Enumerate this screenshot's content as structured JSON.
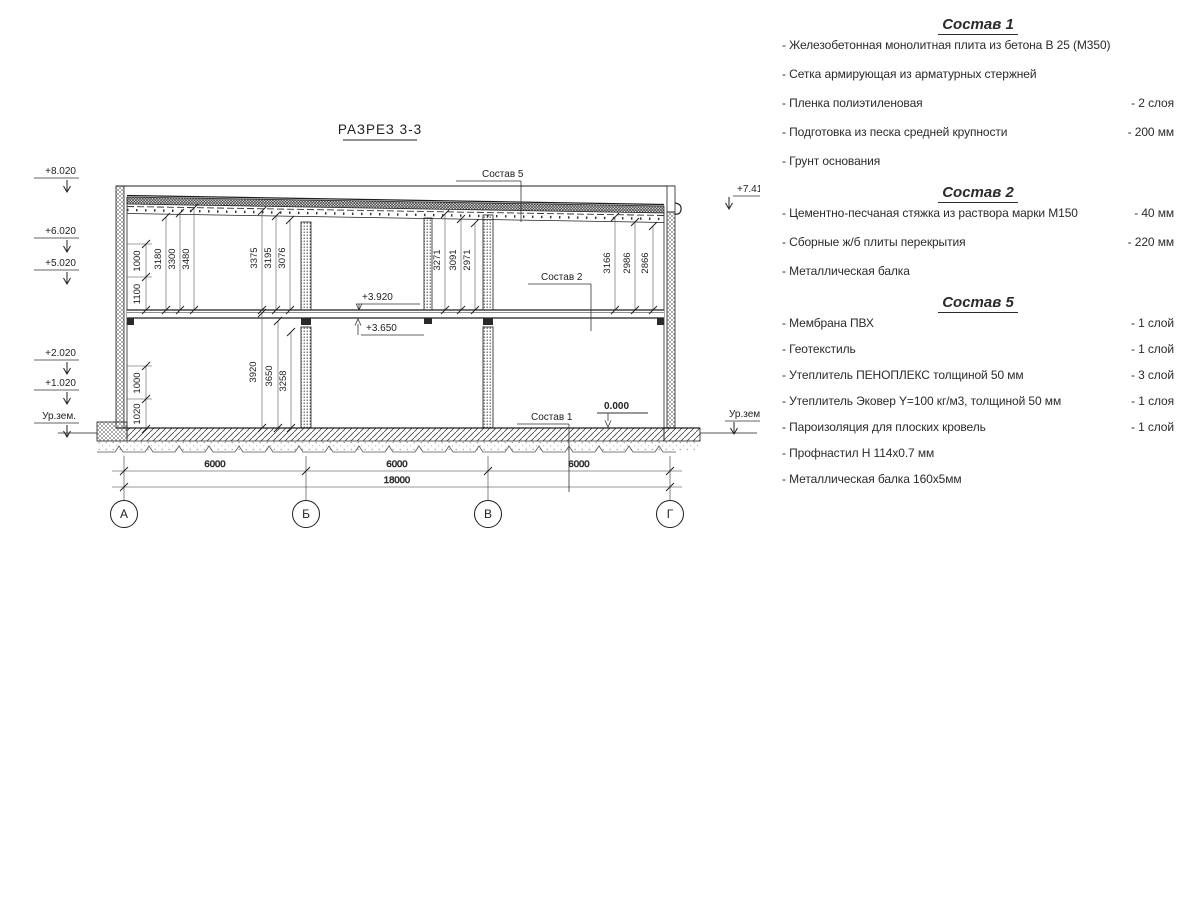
{
  "drawing": {
    "title": "РАЗРЕЗ 3-3",
    "grid": {
      "letters": [
        "А",
        "Б",
        "В",
        "Г"
      ],
      "spans": [
        "6000",
        "6000",
        "6000"
      ],
      "total": "18000"
    },
    "elev_left": [
      "+8.020",
      "+6.020",
      "+5.020",
      "+2.020",
      "+1.020",
      "Ур.зем."
    ],
    "elev_right": [
      "+7.410",
      "Ур.зем."
    ],
    "levels": {
      "l3920": "+3.920",
      "l3650": "+3.650",
      "l0": "0.000"
    },
    "leaders": {
      "s5": "Состав 5",
      "s2": "Состав 2",
      "s1": "Состав 1"
    },
    "dims": {
      "fl2_a": [
        "1000",
        "1100"
      ],
      "fl2_a_long": [
        "3180",
        "3300",
        "3480"
      ],
      "fl2_b": [
        "3375",
        "3195",
        "3076"
      ],
      "fl2_v": [
        "3271",
        "3091",
        "2971"
      ],
      "fl2_g": [
        "3166",
        "2986",
        "2866"
      ],
      "fl1_a": [
        "1000",
        "1020"
      ],
      "fl1_b": [
        "3920",
        "3650",
        "3258"
      ]
    }
  },
  "specs": [
    {
      "title": "Состав 1",
      "items": [
        {
          "name": "- Железобетонная  монолитная плита из бетона В 25 (М350)",
          "value": ""
        },
        {
          "name": "- Сетка армирующая из арматурных стержней",
          "value": ""
        },
        {
          "name": "- Пленка полиэтиленовая",
          "value": "- 2 слоя"
        },
        {
          "name": "- Подготовка из песка средней крупности",
          "value": "- 200 мм"
        },
        {
          "name": "- Грунт основания",
          "value": ""
        }
      ]
    },
    {
      "title": "Состав 2",
      "items": [
        {
          "name": "- Цементно-песчаная стяжка из раствора марки М150",
          "value": "- 40 мм"
        },
        {
          "name": "- Сборные ж/б плиты перекрытия",
          "value": "- 220 мм"
        },
        {
          "name": "- Металлическая балка",
          "value": ""
        }
      ]
    },
    {
      "title": "Состав 5",
      "items": [
        {
          "name": "- Мембрана ПВХ",
          "value": "- 1 слой"
        },
        {
          "name": "- Геотекстиль",
          "value": "- 1 слой"
        },
        {
          "name": "- Утеплитель ПЕНОПЛЕКС толщиной 50 мм",
          "value": "- 3 слой"
        },
        {
          "name": "- Утеплитель Эковер Y=100 кг/м3, толщиной 50 мм",
          "value": "- 1 слоя"
        },
        {
          "name": "- Пароизоляция для плоских кровель",
          "value": "- 1 слой"
        },
        {
          "name": "- Профнастил Н 114х0.7 мм",
          "value": ""
        },
        {
          "name": "- Металлическая балка 160х5мм",
          "value": ""
        }
      ]
    }
  ]
}
